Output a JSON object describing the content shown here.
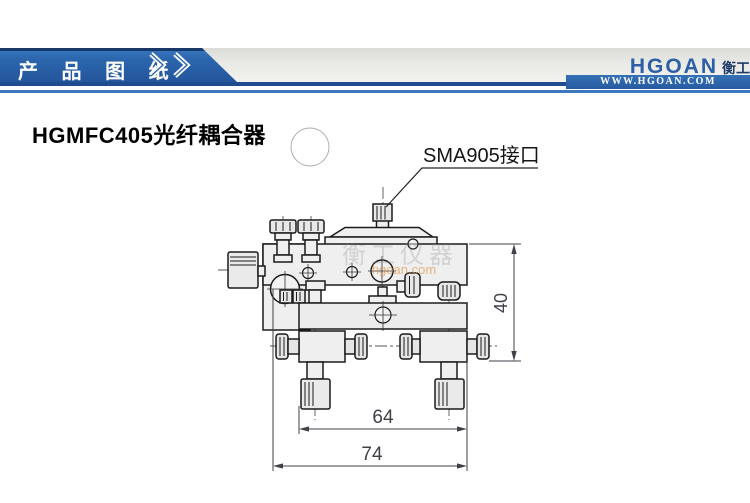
{
  "banner": {
    "title": "产 品 图 纸"
  },
  "logo": {
    "name": "HGOAN",
    "cn": "衡工",
    "url": "WWW.HGOAN.COM"
  },
  "page": {
    "title": "HGMFC405光纤耦合器"
  },
  "drawing": {
    "callout": "SMA905接口",
    "dims": {
      "height": "40",
      "inner_width": "64",
      "outer_width": "74"
    },
    "watermark": {
      "cn": "衡工仪器",
      "url": "hgoan.com"
    }
  },
  "colors": {
    "banner_blue": "#2b66ad",
    "banner_navy": "#1f4c8f",
    "accent_line": "#3c78c0",
    "logo_blue": "#2d5fa7",
    "line_dark": "#1b1b1b",
    "dim_gray": "#3f4147"
  }
}
